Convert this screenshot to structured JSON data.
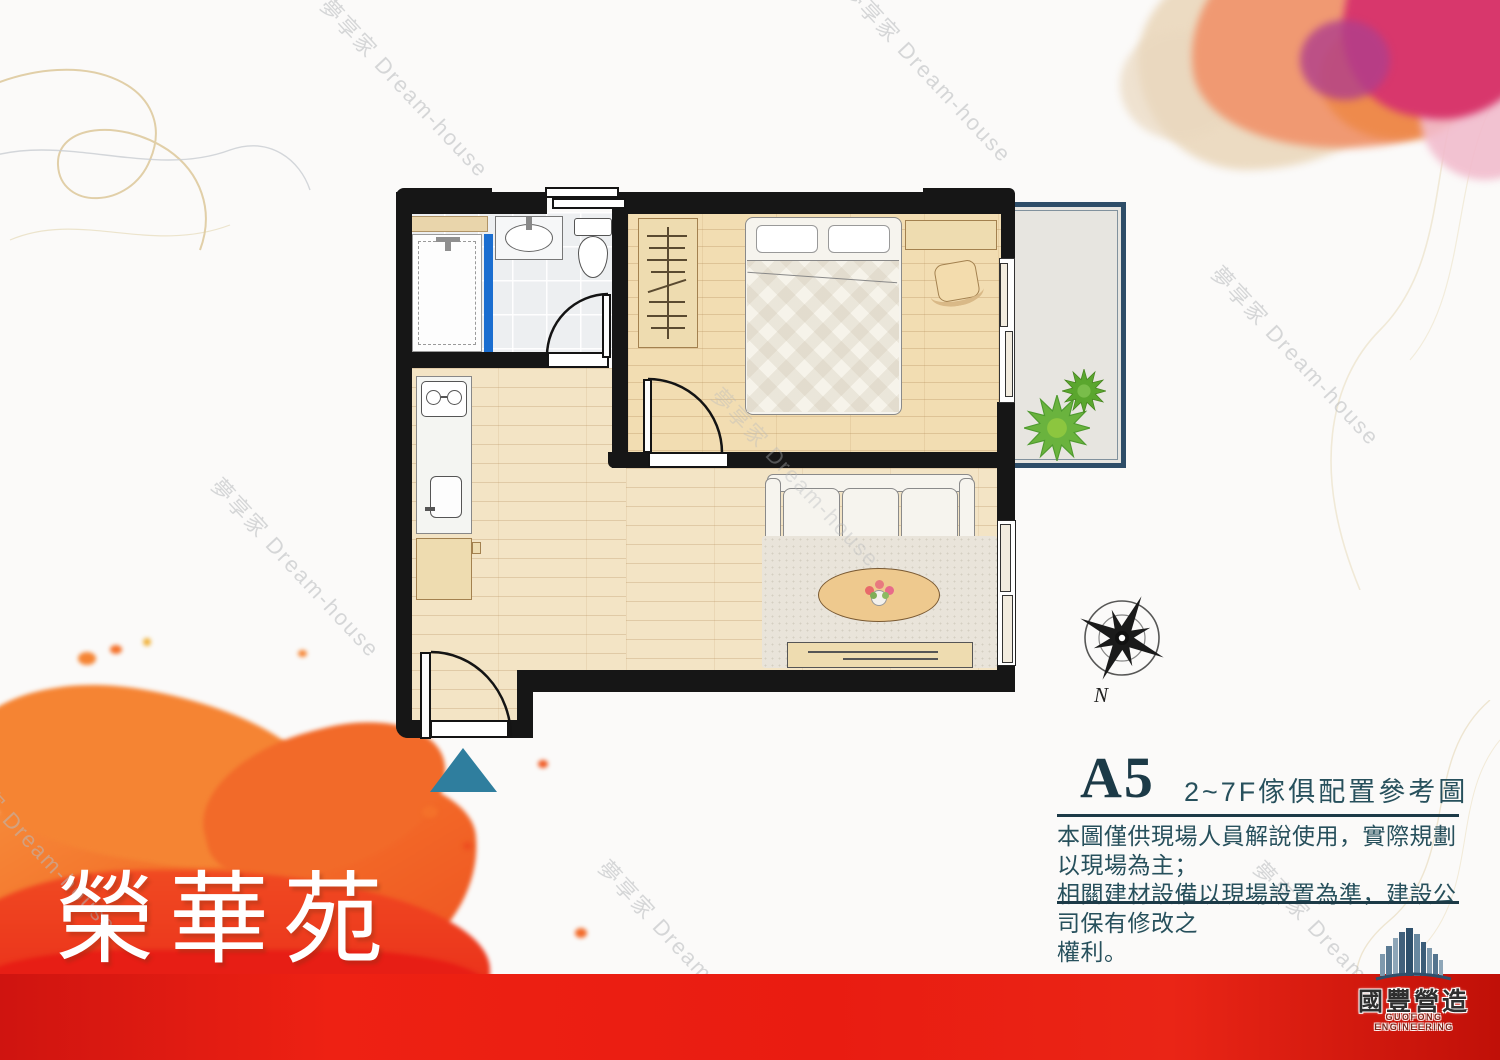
{
  "project": {
    "title": "榮華苑"
  },
  "unit_info": {
    "code": "A5",
    "subtitle": "2~7F傢俱配置參考圖",
    "disclaimer": "本圖僅供現場人員解說使用，實際規劃以現場為主；\n相關建材設備以現場設置為準，建設公司保有修改之\n權利。"
  },
  "compass": {
    "north_label": "N"
  },
  "watermark": {
    "text": "夢享家 Dream-house"
  },
  "developer_logo": {
    "name": "國豐營造",
    "subtitle": "GUOFONG ENGINEERING",
    "icon": "buildings-skyline-icon"
  },
  "entry_marker": {
    "shape": "triangle-up",
    "color": "#2f7e9e"
  },
  "floorplan": {
    "rooms": [
      {
        "name": "bathroom",
        "features": [
          "shower-stall",
          "glass-divider",
          "wash-basin",
          "toilet",
          "swing-door",
          "window"
        ]
      },
      {
        "name": "bedroom",
        "features": [
          "wardrobe",
          "double-bed",
          "desk",
          "chair",
          "sliding-door-to-balcony",
          "swing-door"
        ]
      },
      {
        "name": "kitchen-living",
        "features": [
          "two-burner-stove",
          "kitchen-sink",
          "cabinet",
          "sofa",
          "rug",
          "coffee-table-with-flowers",
          "tv-cabinet",
          "window",
          "entry-door"
        ]
      },
      {
        "name": "balcony",
        "features": [
          "plants"
        ]
      }
    ],
    "colors": {
      "wall": "#161616",
      "wood_floor": "#f3e4c5",
      "bedroom_floor": "#f2ddb2",
      "tile_floor": "#edeff1",
      "furniture_wood": "#eedcb0",
      "glass_blue": "#1b6ed0",
      "balcony_border": "#2e4d68",
      "balcony_floor": "#e7e5e0",
      "plant_green": "#63ad35"
    }
  },
  "colors": {
    "band_red": "#e91c11",
    "splash_orange": "#f4712a",
    "title_teal": "#1c3a47",
    "text_teal": "#27505c",
    "watercolor_pink": "#d8376c",
    "entry_teal": "#2f7e9e",
    "gold_line": "#d8c08c"
  }
}
